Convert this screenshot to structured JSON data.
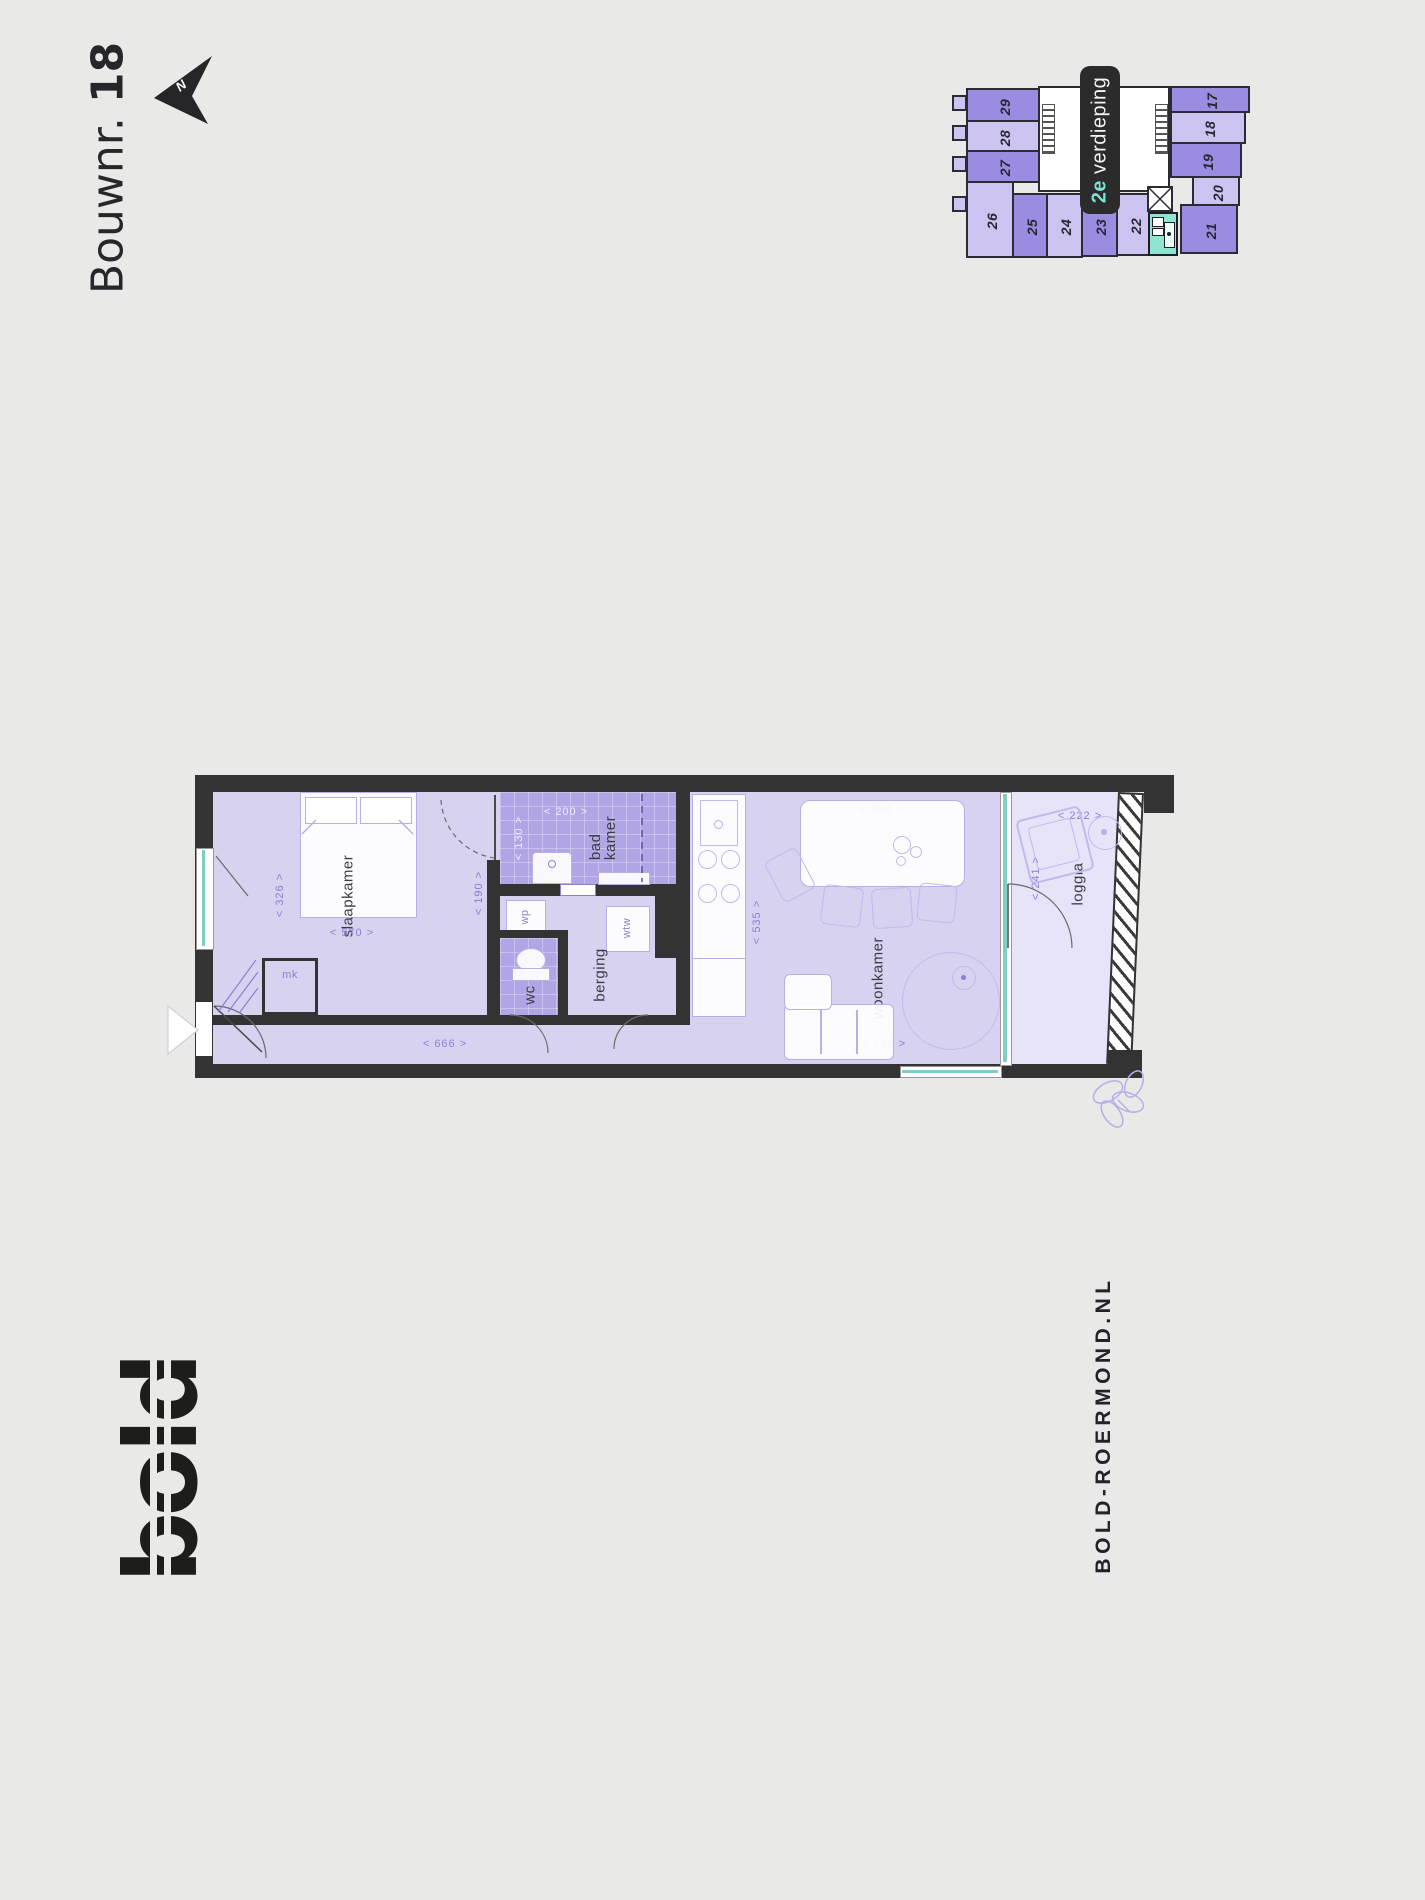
{
  "header": {
    "bouwnr_prefix": "Bouwnr.",
    "bouwnr_number": "18",
    "north": "N"
  },
  "floor_badge": {
    "number": "2e",
    "label": "verdieping"
  },
  "overview_map": {
    "units": {
      "u17": "17",
      "u18": "18",
      "u19": "19",
      "u20": "20",
      "u21": "21",
      "u22": "22",
      "u23": "23",
      "u24": "24",
      "u25": "25",
      "u26": "26",
      "u27": "27",
      "u28": "28",
      "u29": "29"
    }
  },
  "floor_plan": {
    "rooms": {
      "slaapkamer": "slaapkamer",
      "badkamer_line1": "bad",
      "badkamer_line2": "kamer",
      "berging": "berging",
      "wc": "wc",
      "woonkamer": "woonkamer",
      "loggia": "loggia",
      "mk": "mk",
      "wp": "wp",
      "wtw": "wtw"
    },
    "dims": {
      "d326": "< 326 >",
      "d570": "< 570 >",
      "d190": "< 190 >",
      "d200": "< 200 >",
      "d130": "< 130 >",
      "d666": "< 666 >",
      "d534": "< 534 >",
      "d535": "< 535 >",
      "d739": "< 739 >",
      "d222": "< 222 >",
      "d241": "< 241 >"
    }
  },
  "footer": {
    "logo": "bold",
    "site": "BOLD-ROERMOND.NL"
  },
  "colors": {
    "accent_teal": "#7fd0c4",
    "purple_dark": "#9c8ce1",
    "purple_light": "#cdc3f0",
    "floor": "#d8d2f1",
    "wet_room": "#b2a5e6",
    "wall": "#333334"
  }
}
